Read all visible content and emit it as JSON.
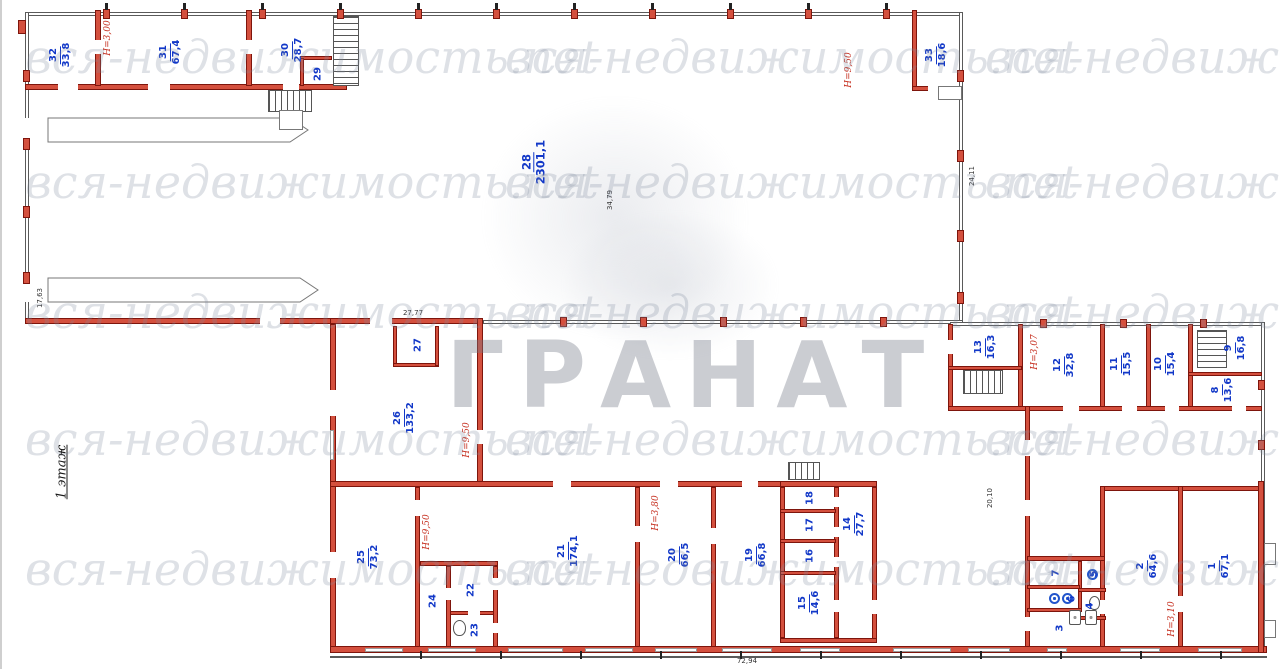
{
  "watermark": {
    "text": "вся-недвижимость.net",
    "stamp": "ГРАНАТ"
  },
  "floor_label": "1 этаж",
  "colors": {
    "wall_red": "#d4503e",
    "wall_border": "#7e150c",
    "room_label_blue": "#1238c8",
    "height_label_red": "#c52c1c"
  },
  "rooms": {
    "r1": {
      "num": "1",
      "area": "67,1"
    },
    "r2": {
      "num": "2",
      "area": "64,6"
    },
    "r3": {
      "num": "3",
      "area": ""
    },
    "r4": {
      "num": "4",
      "area": ""
    },
    "r5": {
      "num": "5",
      "area": ""
    },
    "r6": {
      "num": "6",
      "area": ""
    },
    "r7": {
      "num": "7",
      "area": ""
    },
    "r8": {
      "num": "8",
      "area": "13,6"
    },
    "r9": {
      "num": "9",
      "area": "16,8"
    },
    "r10": {
      "num": "10",
      "area": "15,4"
    },
    "r11": {
      "num": "11",
      "area": "15,5"
    },
    "r12": {
      "num": "12",
      "area": "32,8"
    },
    "r13": {
      "num": "13",
      "area": "16,3"
    },
    "r14": {
      "num": "14",
      "area": "27,7"
    },
    "r15": {
      "num": "15",
      "area": "14,6"
    },
    "r16": {
      "num": "16",
      "area": ""
    },
    "r17": {
      "num": "17",
      "area": ""
    },
    "r18": {
      "num": "18",
      "area": ""
    },
    "r19": {
      "num": "19",
      "area": "66,8"
    },
    "r20": {
      "num": "20",
      "area": "66,5"
    },
    "r21": {
      "num": "21",
      "area": "174,1"
    },
    "r22": {
      "num": "22",
      "area": ""
    },
    "r23": {
      "num": "23",
      "area": ""
    },
    "r24": {
      "num": "24",
      "area": ""
    },
    "r25": {
      "num": "25",
      "area": "73,2"
    },
    "r26": {
      "num": "26",
      "area": "133,2"
    },
    "r27": {
      "num": "27",
      "area": ""
    },
    "r28": {
      "num": "28",
      "area": "2301,1"
    },
    "r29": {
      "num": "29",
      "area": ""
    },
    "r30": {
      "num": "30",
      "area": "28,7"
    },
    "r31": {
      "num": "31",
      "area": "67,4"
    },
    "r32": {
      "num": "32",
      "area": "33,8"
    },
    "r33": {
      "num": "33",
      "area": "18,6"
    }
  },
  "heights": {
    "h1": "Н=3,00",
    "h2": "Н=9,50",
    "h3": "Н=3,07",
    "h4": "Н=9,50",
    "h5": "Н=9,50",
    "h6": "Н=3,80",
    "h7": "Н=3,10"
  },
  "dimensions": {
    "d1": "24,11",
    "d2": "17,63",
    "d3": "34,79",
    "d4": "27,77",
    "d5": "20,10",
    "d6": "72,94"
  }
}
